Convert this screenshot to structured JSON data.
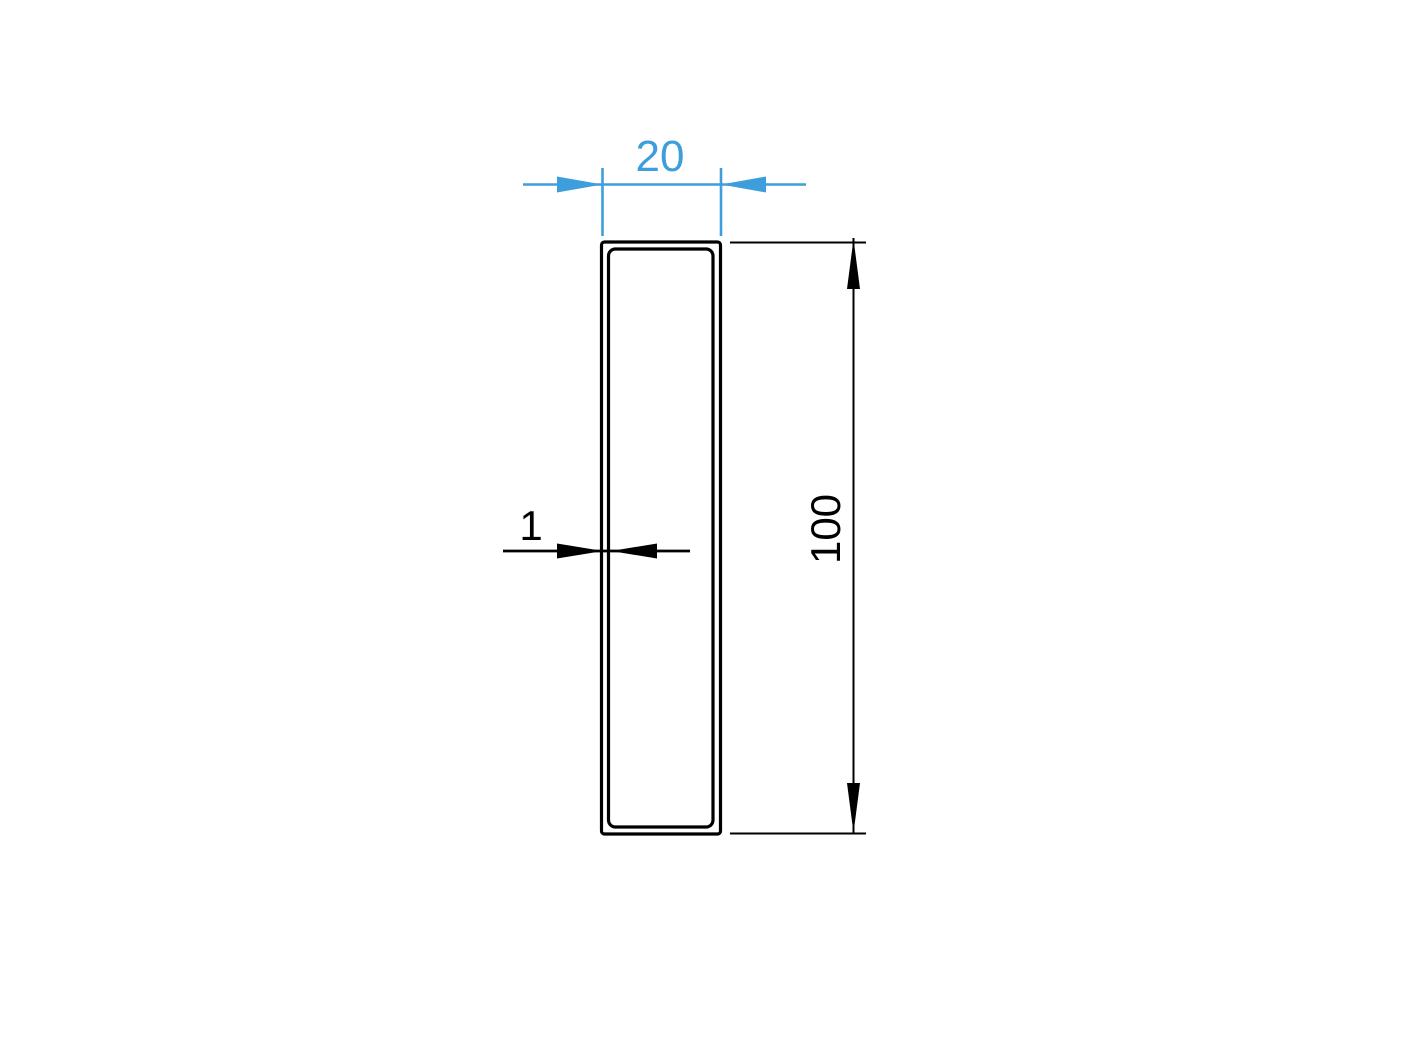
{
  "colors": {
    "background": "#ffffff",
    "line_black": "#000000",
    "accent_blue": "#3d9edb"
  },
  "dimensions": {
    "width": {
      "value": "20"
    },
    "height": {
      "value": "100"
    },
    "wall_thickness": {
      "value": "1"
    }
  }
}
